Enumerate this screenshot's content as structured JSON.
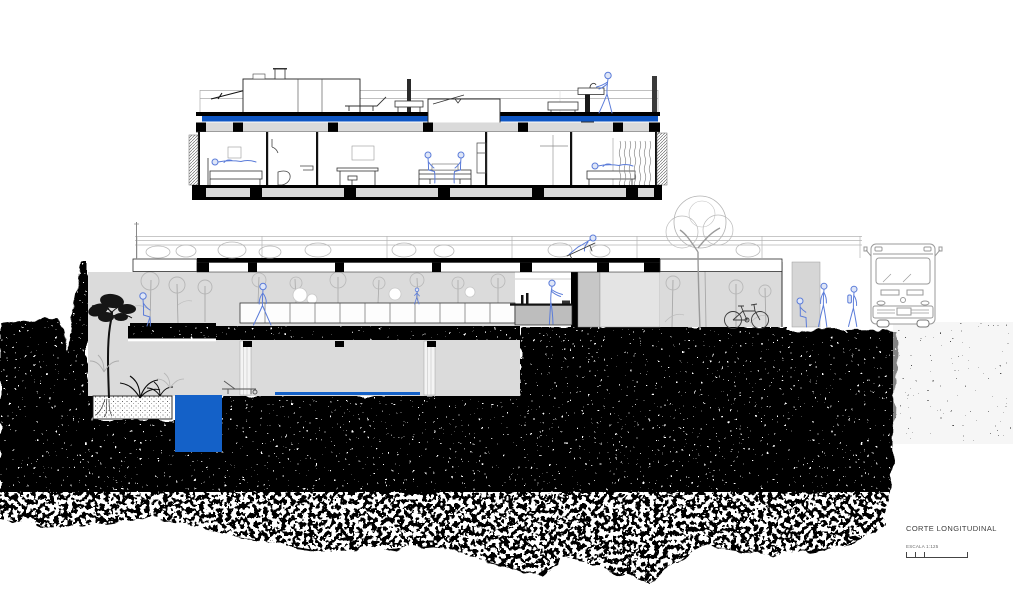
{
  "annotation": {
    "title": "CORTE LONGITUDINAL",
    "scale_label": "ESCALA 1:125",
    "scale_bar_ticks": 4
  },
  "palette": {
    "water_blue": "#1461C8",
    "roof_membrane_blue": "#0E56C4",
    "people_blue": "#5B7CD9",
    "poche_black": "#000000",
    "cut_earth_gray": "#DBDBDB",
    "vegetation_gray": "#B3B3B3"
  },
  "upper_level_section": {
    "rooms": [
      "bedroom with bed and person lying",
      "bathroom with shower and toilet",
      "study with wall basin, desk and stools",
      "living room with sofa and two seated people",
      "bedroom with bed, person lying and curtain"
    ],
    "roof_elements": [
      "guardrail",
      "solar panel",
      "skylight box",
      "chimney",
      "stair bulkhead",
      "sun lounger",
      "low table",
      "bench",
      "outdoor sink",
      "person standing at sink"
    ]
  },
  "garden_level_section": {
    "elements": [
      "roof garden with shrubs and guardrail",
      "person lounging on deck chair",
      "interior garden with trees",
      "long low window band",
      "person sitting on slab edge",
      "person walking in garden",
      "small person in garden",
      "kitchen counter with person cooking",
      "gray service doors",
      "garden room with parked bicycle",
      "bus stop wall",
      "seated waiting person",
      "standing waiting person",
      "standing person with backpack",
      "bus at street level"
    ]
  },
  "lower_level": {
    "elements": [
      "sunken pool terrace",
      "pool",
      "reflecting water line",
      "pool lounge chair",
      "planter box with tree roots",
      "black tree",
      "palm plants",
      "earth poche black stippled"
    ]
  }
}
